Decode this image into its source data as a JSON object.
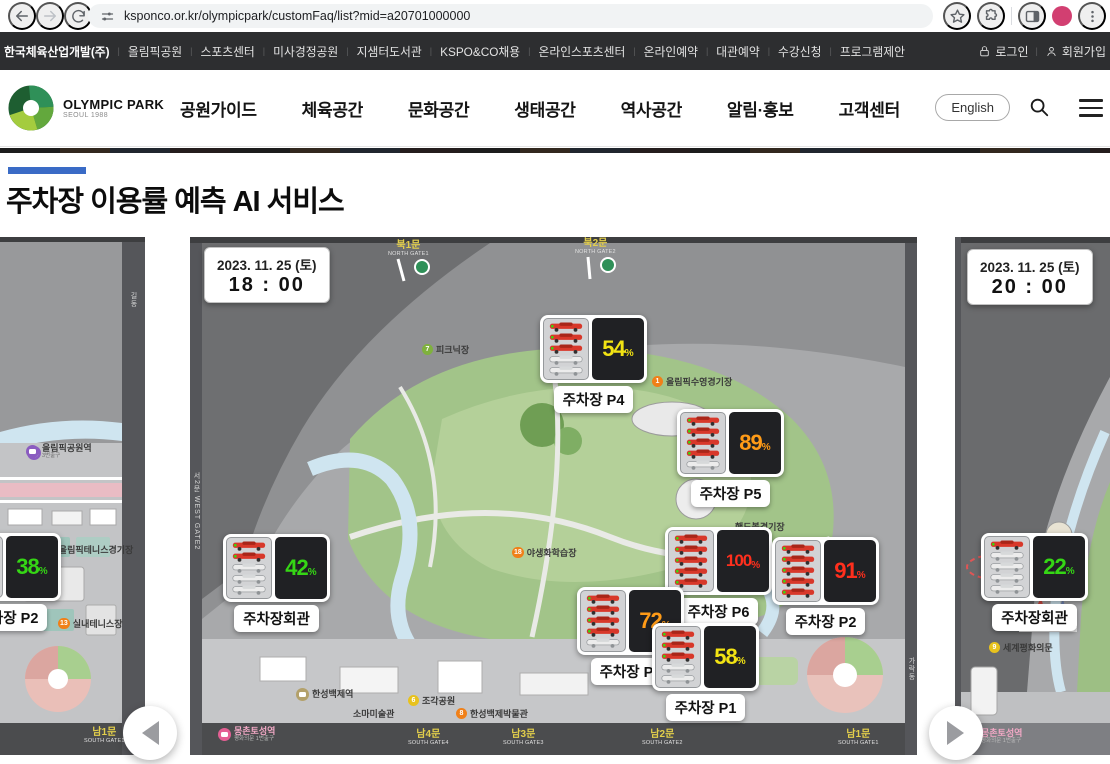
{
  "browser": {
    "url": "ksponco.or.kr/olympicpark/customFaq/list?mid=a20701000000"
  },
  "utility_nav": {
    "links": [
      "한국체육산업개발(주)",
      "올림픽공원",
      "스포츠센터",
      "미사경정공원",
      "지샘터도서관",
      "KSPO&CO채용",
      "온라인스포츠센터",
      "온라인예약",
      "대관예약",
      "수강신청",
      "프로그램제안"
    ],
    "login_label": "로그인",
    "join_label": "회원가입"
  },
  "header": {
    "logo_title": "OLYMPIC PARK",
    "logo_subtitle": "SEOUL 1988",
    "nav": [
      "공원가이드",
      "체육공간",
      "문화공간",
      "생태공간",
      "역사공간",
      "알림·홍보",
      "고객센터"
    ],
    "english_label": "English"
  },
  "page": {
    "title": "주차장 이용률 예측 AI 서비스"
  },
  "status_colors": {
    "low_green": "#35d615",
    "mid_yellow": "#f2e313",
    "high_orange": "#ff9b17",
    "full_red": "#ff2f1d"
  },
  "carousel": {
    "panels": [
      {
        "id": "prev",
        "markers": [
          {
            "name": "주차장 P2",
            "pct": 38,
            "color": "#35d615",
            "x": -46,
            "y": 296
          }
        ],
        "labels": [
          {
            "kind": "station",
            "text": "올림픽공원역",
            "sub": "3번출구",
            "color": "#8a5cc0",
            "x": 26,
            "y": 206
          },
          {
            "kind": "poi",
            "text": "올림픽테니스경기장",
            "dot": "14",
            "dot_color": "#f08019",
            "x": 44,
            "y": 306
          },
          {
            "kind": "poi",
            "text": "실내테니스장",
            "dot": "13",
            "dot_color": "#f08019",
            "x": 58,
            "y": 380
          },
          {
            "kind": "gate",
            "text": "남1문",
            "sub": "SOUTH GATE1",
            "x": 84,
            "y": 490
          }
        ],
        "frame_labels": [
          {
            "text": "길동",
            "x": 128,
            "y": 55
          }
        ]
      },
      {
        "id": "current",
        "date": "2023. 11. 25 (토)",
        "time": "18 : 00",
        "markers": [
          {
            "name": "주차장 P4",
            "pct": 54,
            "color": "#f2e313",
            "x": 350,
            "y": 78
          },
          {
            "name": "주차장 P5",
            "pct": 89,
            "color": "#ff9b17",
            "x": 487,
            "y": 172
          },
          {
            "name": "주차장 P6",
            "pct": 100,
            "color": "#ff2f1d",
            "x": 475,
            "y": 290
          },
          {
            "name": "주차장 P2",
            "pct": 91,
            "color": "#ff2f1d",
            "x": 582,
            "y": 300
          },
          {
            "name": "주차장 P7",
            "pct": 72,
            "color": "#ff9b17",
            "x": 387,
            "y": 350
          },
          {
            "name": "주차장 P1",
            "pct": 58,
            "color": "#f2e313",
            "x": 462,
            "y": 386
          },
          {
            "name": "주차장회관",
            "pct": 42,
            "color": "#35d615",
            "x": 33,
            "y": 297
          }
        ],
        "labels": [
          {
            "kind": "gate",
            "text": "북1문",
            "sub": "NORTH GATE1",
            "x": 198,
            "y": 3
          },
          {
            "kind": "gate",
            "text": "북2문",
            "sub": "NORTH GATE2",
            "x": 385,
            "y": 1
          },
          {
            "kind": "poi",
            "text": "피크닉장",
            "dot": "7",
            "dot_color": "#7fb13d",
            "x": 232,
            "y": 106
          },
          {
            "kind": "poi",
            "text": "올림픽수영경기장",
            "dot": "1",
            "dot_color": "#f08019",
            "x": 462,
            "y": 138
          },
          {
            "kind": "poi",
            "text": "핸드볼경기장",
            "x": 545,
            "y": 283
          },
          {
            "kind": "poi",
            "text": "야생화학습장",
            "dot": "18",
            "dot_color": "#f08019",
            "x": 322,
            "y": 309
          },
          {
            "kind": "station",
            "text": "한성백제역",
            "color": "#b3a16b",
            "x": 106,
            "y": 451
          },
          {
            "kind": "poi",
            "text": "소마미술관",
            "x": 163,
            "y": 470
          },
          {
            "kind": "poi",
            "text": "조각공원",
            "dot": "6",
            "dot_color": "#e8c21d",
            "x": 218,
            "y": 457
          },
          {
            "kind": "poi",
            "text": "한성백제박물관",
            "dot": "8",
            "dot_color": "#f08019",
            "x": 266,
            "y": 470
          },
          {
            "kind": "station",
            "dark": true,
            "text": "몽촌토성역",
            "sub": "평화의문 1번출구",
            "color": "#e45f93",
            "x": 28,
            "y": 489
          },
          {
            "kind": "gate",
            "text": "남4문",
            "sub": "SOUTH GATE4",
            "x": 218,
            "y": 492
          },
          {
            "kind": "gate",
            "text": "남3문",
            "sub": "SOUTH GATE3",
            "x": 313,
            "y": 492
          },
          {
            "kind": "gate",
            "text": "남2문",
            "sub": "SOUTH GATE2",
            "x": 452,
            "y": 492
          },
          {
            "kind": "gate",
            "text": "남1문",
            "sub": "SOUTH GATE1",
            "x": 648,
            "y": 492
          }
        ],
        "frame_labels": [
          {
            "text": "서2문 WEST GATE2",
            "x": 1,
            "y": 235
          },
          {
            "text": "가락동",
            "x": 716,
            "y": 420
          }
        ]
      },
      {
        "id": "next",
        "date": "2023. 11. 25 (토)",
        "time": "20 : 00",
        "markers": [
          {
            "name": "주차장회관",
            "pct": 22,
            "color": "#35d615",
            "x": 26,
            "y": 296
          }
        ],
        "labels": [
          {
            "kind": "poi",
            "text": "세계평화의문",
            "dot": "9",
            "dot_color": "#e8c21d",
            "x": 34,
            "y": 404
          },
          {
            "kind": "station",
            "dark": true,
            "text": "몽촌토성역",
            "sub": "평화의문 1번출구",
            "color": "#e45f93",
            "x": 10,
            "y": 491
          }
        ],
        "frame_labels": []
      }
    ]
  }
}
